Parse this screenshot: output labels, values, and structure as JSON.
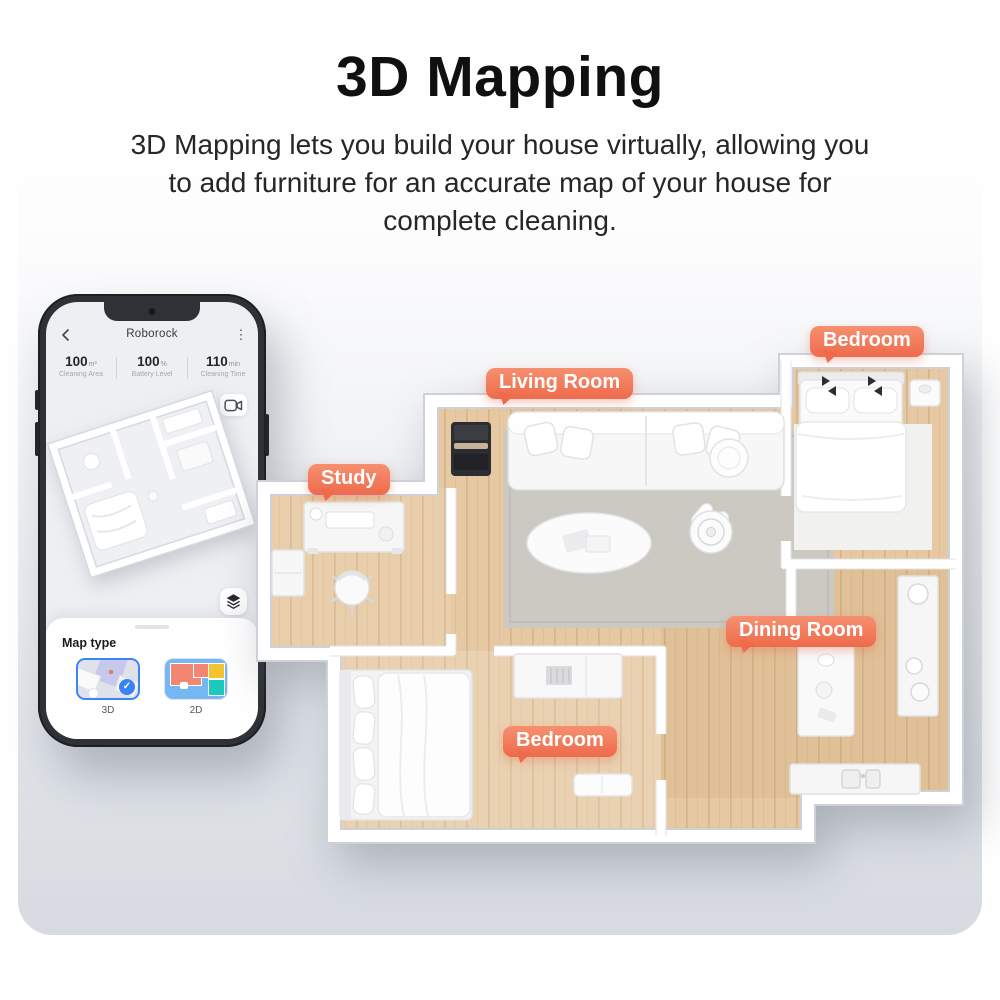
{
  "header": {
    "title": "3D Mapping",
    "subtitle_lines": [
      "3D Mapping lets you build your house virtually, allowing you",
      "to add furniture for an accurate map of your house for",
      "complete cleaning."
    ]
  },
  "phone": {
    "app_header": {
      "title": "Roborock"
    },
    "stats": [
      {
        "value": "100",
        "unit": "m²",
        "label": "Cleaning Area"
      },
      {
        "value": "100",
        "unit": "%",
        "label": "Battery Level"
      },
      {
        "value": "110",
        "unit": "min",
        "label": "Cleaning Time"
      }
    ],
    "map_sheet": {
      "title": "Map type",
      "options": [
        {
          "label": "3D",
          "selected": true
        },
        {
          "label": "2D",
          "selected": false
        }
      ]
    },
    "icons": [
      "back-icon",
      "kebab-menu-icon",
      "video-camera-icon",
      "layers-icon",
      "check-icon"
    ]
  },
  "floorplan": {
    "labels": [
      {
        "id": "living-room",
        "text": "Living Room"
      },
      {
        "id": "bedroom-top",
        "text": "Bedroom"
      },
      {
        "id": "study",
        "text": "Study"
      },
      {
        "id": "dining-room",
        "text": "Dining Room"
      },
      {
        "id": "bedroom-bottom",
        "text": "Bedroom"
      }
    ]
  },
  "colors": {
    "label_bubble_top": "#F69070",
    "label_bubble_bottom": "#EF6A4B",
    "accent_blue": "#3B82F6",
    "wood_floor": "#E6C9A2",
    "map2d_blue": "#74B7F3",
    "map2d_coral": "#F28672",
    "map2d_yellow": "#F5C52F",
    "map2d_teal": "#1CC9BF"
  }
}
